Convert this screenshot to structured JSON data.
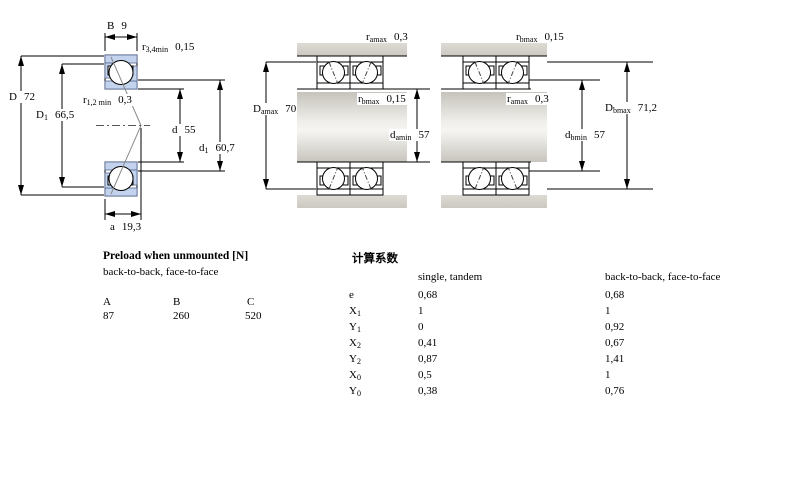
{
  "colors": {
    "hatch_blue": "#c3d3ee",
    "housing_gray": "#d3d0c9",
    "line_black": "#000000"
  },
  "dims": {
    "B": {
      "base": "B",
      "sub": "",
      "value": "9"
    },
    "r34": {
      "base": "r",
      "sub": "3,4min",
      "value": "0,15"
    },
    "D": {
      "base": "D",
      "sub": "",
      "value": "72"
    },
    "D1": {
      "base": "D",
      "sub": "1",
      "value": "66,5"
    },
    "r12": {
      "base": "r",
      "sub": "1,2 min",
      "value": "0,3"
    },
    "d": {
      "base": "d",
      "sub": "",
      "value": "55"
    },
    "d1": {
      "base": "d",
      "sub": "1",
      "value": "60,7"
    },
    "a": {
      "base": "a",
      "sub": "",
      "value": "19,3"
    },
    "ramax_top": {
      "base": "r",
      "sub": "amax",
      "value": "0,3"
    },
    "Damax": {
      "base": "D",
      "sub": "amax",
      "value": "70"
    },
    "rbmax_mid": {
      "base": "r",
      "sub": "bmax",
      "value": "0,15"
    },
    "damin": {
      "base": "d",
      "sub": "amin",
      "value": "57"
    },
    "rbmax_top": {
      "base": "r",
      "sub": "bmax",
      "value": "0,15"
    },
    "ramax_mid": {
      "base": "r",
      "sub": "amax",
      "value": "0,3"
    },
    "Dbmax": {
      "base": "D",
      "sub": "bmax",
      "value": "71,2"
    },
    "dbmin": {
      "base": "d",
      "sub": "bmin",
      "value": "57"
    }
  },
  "preload_table": {
    "title": "Preload when unmounted [N]",
    "subtitle": "back-to-back, face-to-face",
    "columns": [
      "A",
      "B",
      "C"
    ],
    "values": [
      "87",
      "260",
      "520"
    ]
  },
  "factors_table": {
    "title": "计算系数",
    "col_single": "single, tandem",
    "col_btb": "back-to-back, face-to-face",
    "rows": [
      {
        "base": "e",
        "sub": "",
        "single": "0,68",
        "btb": "0,68"
      },
      {
        "base": "X",
        "sub": "1",
        "single": "1",
        "btb": "1"
      },
      {
        "base": "Y",
        "sub": "1",
        "single": "0",
        "btb": "0,92"
      },
      {
        "base": "X",
        "sub": "2",
        "single": "0,41",
        "btb": "0,67"
      },
      {
        "base": "Y",
        "sub": "2",
        "single": "0,87",
        "btb": "1,41"
      },
      {
        "base": "X",
        "sub": "0",
        "single": "0,5",
        "btb": "1"
      },
      {
        "base": "Y",
        "sub": "0",
        "single": "0,38",
        "btb": "0,76"
      }
    ]
  }
}
